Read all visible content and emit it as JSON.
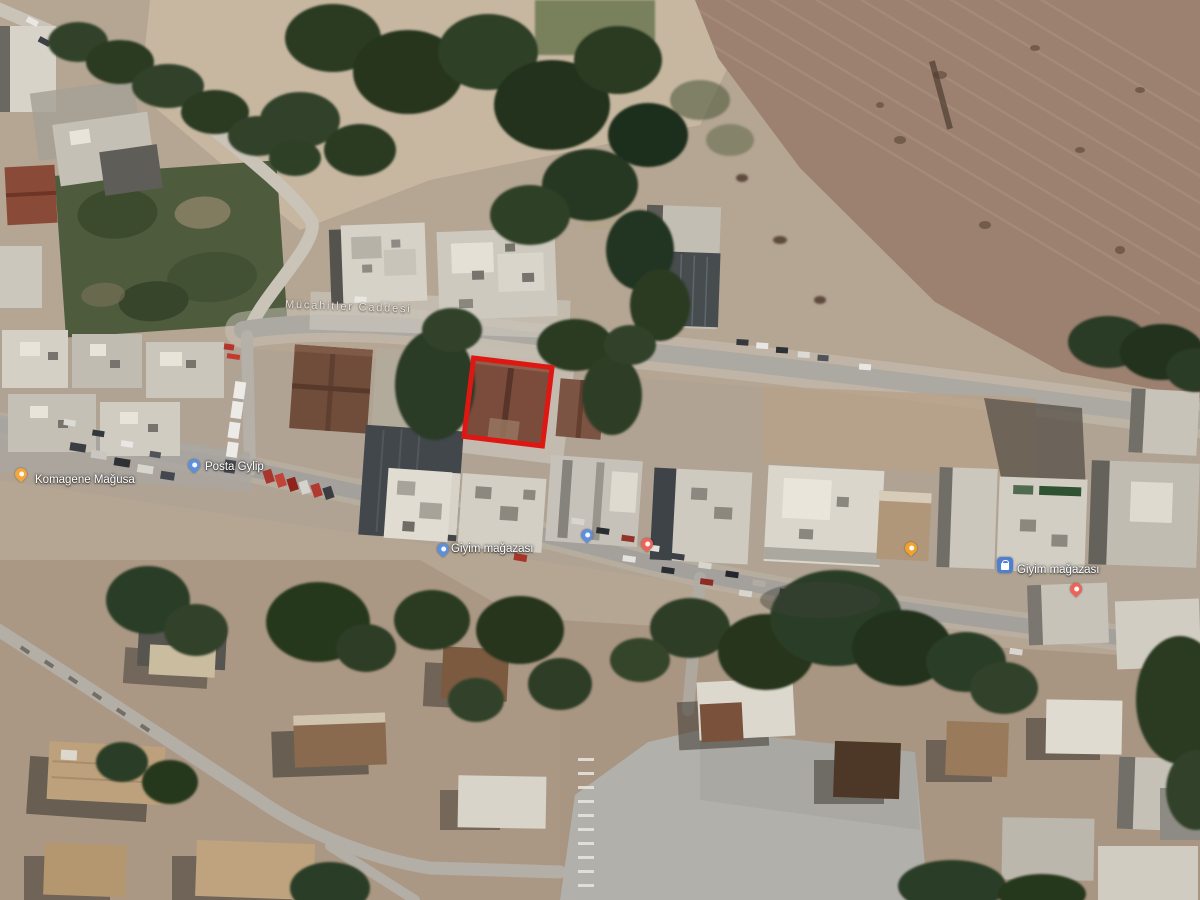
{
  "map": {
    "view": "satellite",
    "street_label": {
      "text": "Mücahitler Caddesi"
    },
    "markers": [
      {
        "id": "komagene-magusa",
        "icon": "orange-pin",
        "color": "#f2a63b",
        "x": 21,
        "y": 483,
        "label": "Komagene Mağusa",
        "label_dx": 14,
        "label_dy": -9
      },
      {
        "id": "posta-gylip",
        "icon": "blue-pin",
        "color": "#5f8fd9",
        "x": 194,
        "y": 474,
        "label": "Posta Gylip",
        "label_dx": 11,
        "label_dy": -13
      },
      {
        "id": "giyim-magazasi-west",
        "icon": "blue-pin",
        "color": "#5f8fd9",
        "x": 443,
        "y": 558,
        "label": "Giyim mağazası",
        "label_dx": 8,
        "label_dy": -15
      },
      {
        "id": "shop-pin-blue",
        "icon": "blue-pin",
        "color": "#5f8fd9",
        "x": 587,
        "y": 544,
        "label": ""
      },
      {
        "id": "shop-pin-red",
        "icon": "red-pin",
        "color": "#ea6458",
        "x": 647,
        "y": 553,
        "label": ""
      },
      {
        "id": "poi-pin-yellow",
        "icon": "yellow-pin",
        "color": "#f0a32c",
        "x": 911,
        "y": 557,
        "label": ""
      },
      {
        "id": "giyim-magazasi-east",
        "icon": "blue-square",
        "color": "#4f7fd0",
        "x": 1005,
        "y": 573,
        "label": "Giyim mağazası",
        "label_dx": 12,
        "label_dy": -9
      },
      {
        "id": "poi-pin-red-east",
        "icon": "red-pin",
        "color": "#ea6458",
        "x": 1076,
        "y": 598,
        "label": ""
      }
    ],
    "annotation": {
      "label": "highlighted-building-outline",
      "x": 466,
      "y": 360,
      "width": 84,
      "height": 84,
      "rotation_deg": 7,
      "color": "#df1712",
      "thickness": 5
    }
  }
}
